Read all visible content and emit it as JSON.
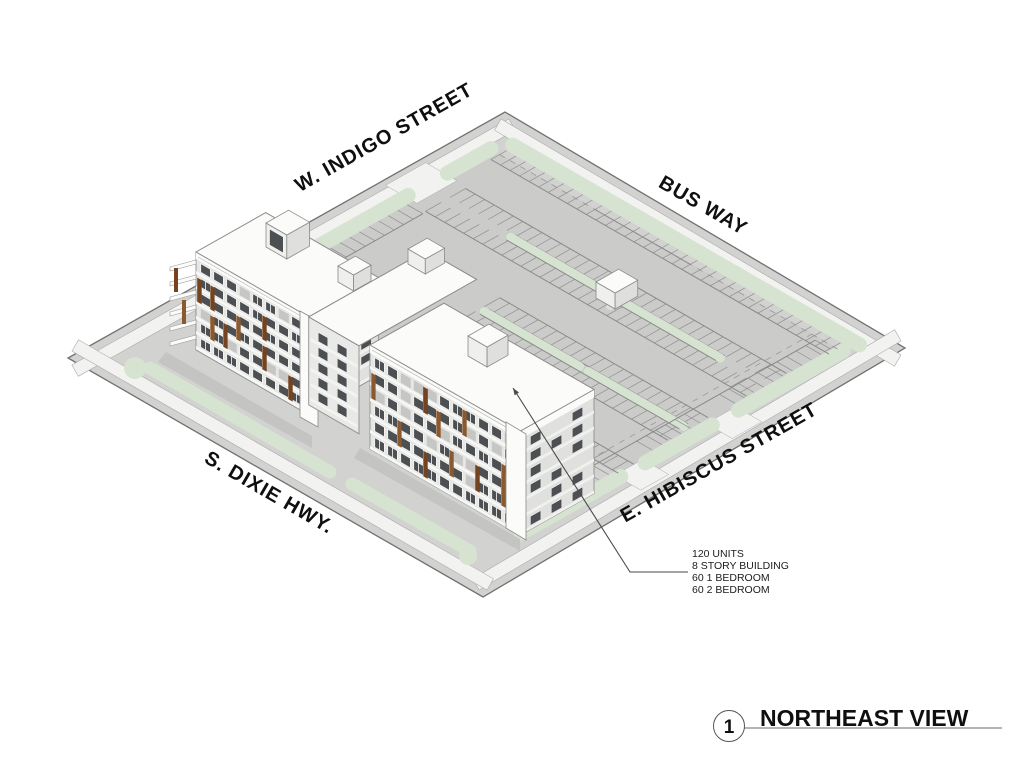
{
  "figure": {
    "number": "1",
    "title": "NORTHEAST VIEW"
  },
  "streets": {
    "top": "W. INDIGO STREET",
    "right": "BUS WAY",
    "left": "S. DIXIE HWY.",
    "bottom": "E. HIBISCUS STREET"
  },
  "annotation": {
    "lines": [
      "120 UNITS",
      "8 STORY BUILDING",
      "60 1 BEDROOM",
      "60 2 BEDROOM"
    ]
  },
  "scene": {
    "colors": {
      "site_gray": "#d2d2d1",
      "parking_gray": "#cbcbca",
      "sidewalk": "#f2f2f0",
      "landscape_green": "#d7e3d1",
      "building_white": "#fbfbfa",
      "facade_gray": "#e6e6e4",
      "end_face_gray": "#e0e0de",
      "window_dark": "#4d5053",
      "panel_gray": "#c6c6c4",
      "accent_brown": "#74431f",
      "accent_brown_light": "#8a5a2e",
      "line_gray": "#8f8f8f",
      "curb_gray": "#8a8a8a",
      "shadow_gray": "#c2c2c1",
      "outline": "#707070",
      "leader": "#4a4a4a"
    }
  }
}
